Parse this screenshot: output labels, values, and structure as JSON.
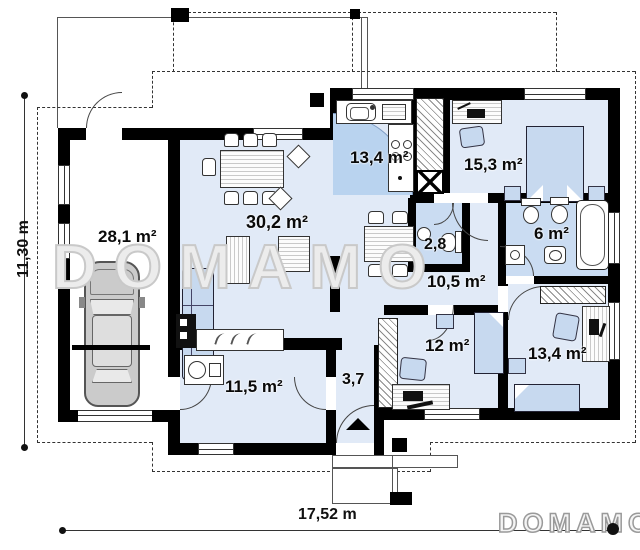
{
  "watermark": "DOMAMO",
  "logo": "DOMAMO",
  "dimensions": {
    "height_label": "11,30 m",
    "width_label": "17,52 m"
  },
  "rooms": {
    "garage": "28,1 m²",
    "living": "30,2 m²",
    "kitchen": "13,4 m²",
    "bedroom_top": "15,3 m²",
    "wc": "2,8",
    "bathroom": "6 m²",
    "hall": "10,5 m²",
    "office": "12 m²",
    "bedroom_right": "13,4 m²",
    "multipurpose": "11,5 m²",
    "entry": "3,7"
  },
  "colors": {
    "floor": "#e1eaf7",
    "wet_floor": "#cadcf2",
    "door_swing": "#b9d3ef",
    "furniture": "#c7d9ef",
    "wall": "#000000",
    "watermark_outline": "#c9c9c9"
  }
}
